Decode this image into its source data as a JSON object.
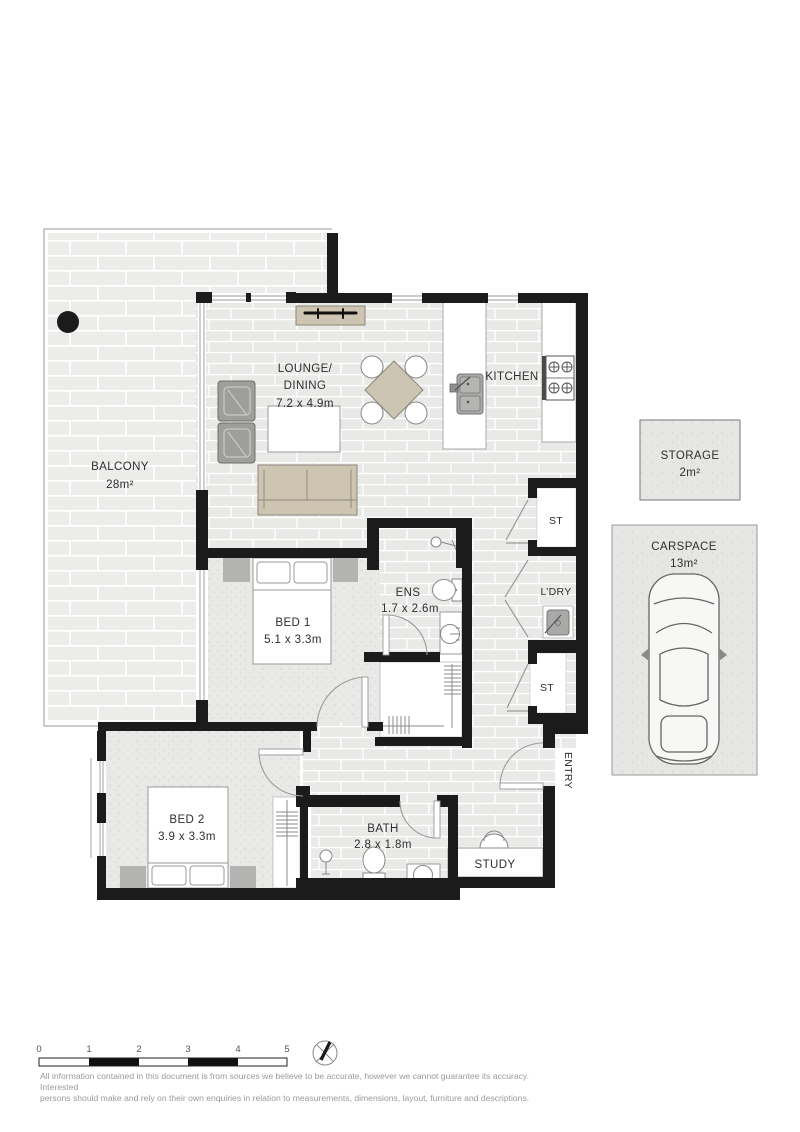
{
  "rooms": {
    "balcony": {
      "name": "BALCONY",
      "area": "28m²"
    },
    "lounge_dining": {
      "line1": "LOUNGE/",
      "line2": "DINING",
      "dims": "7.2 x 4.9m"
    },
    "kitchen": {
      "name": "KITCHEN"
    },
    "bed1": {
      "name": "BED 1",
      "dims": "5.1 x 3.3m"
    },
    "ensuite": {
      "name": "ENS",
      "dims": "1.7 x 2.6m"
    },
    "bed2": {
      "name": "BED 2",
      "dims": "3.9 x 3.3m"
    },
    "bath": {
      "name": "BATH",
      "dims": "2.8 x 1.8m"
    },
    "study": {
      "name": "STUDY"
    },
    "entry": {
      "name": "ENTRY"
    },
    "laundry": {
      "name": "L’DRY"
    },
    "store_1": {
      "name": "ST"
    },
    "store_2": {
      "name": "ST"
    }
  },
  "external_areas": {
    "storage": {
      "name": "STORAGE",
      "area": "2m²"
    },
    "carspace": {
      "name": "CARSPACE",
      "area": "13m²"
    }
  },
  "scale_bar": {
    "ticks": [
      "0",
      "1",
      "2",
      "3",
      "4",
      "5"
    ]
  },
  "north_arrow": {
    "icon": "compass-north-arrow"
  },
  "disclaimer": {
    "line1": "All information contained in this document is from sources we believe to be accurate, however we cannot guarantee its accuracy. Interested",
    "line2": "persons should make and rely on their own enquiries in relation to measurements, dimensions, layout, furniture and descriptions."
  },
  "colors": {
    "wall": "#1b1b1b",
    "tile": "#e9e9e7",
    "carpet": "#e8e8e6",
    "furniture_tan": "#cdc4b2",
    "furniture_grey": "#9e9e9c",
    "label_text": "#2e2e2e",
    "disclaimer_text": "#9a9a9a"
  }
}
